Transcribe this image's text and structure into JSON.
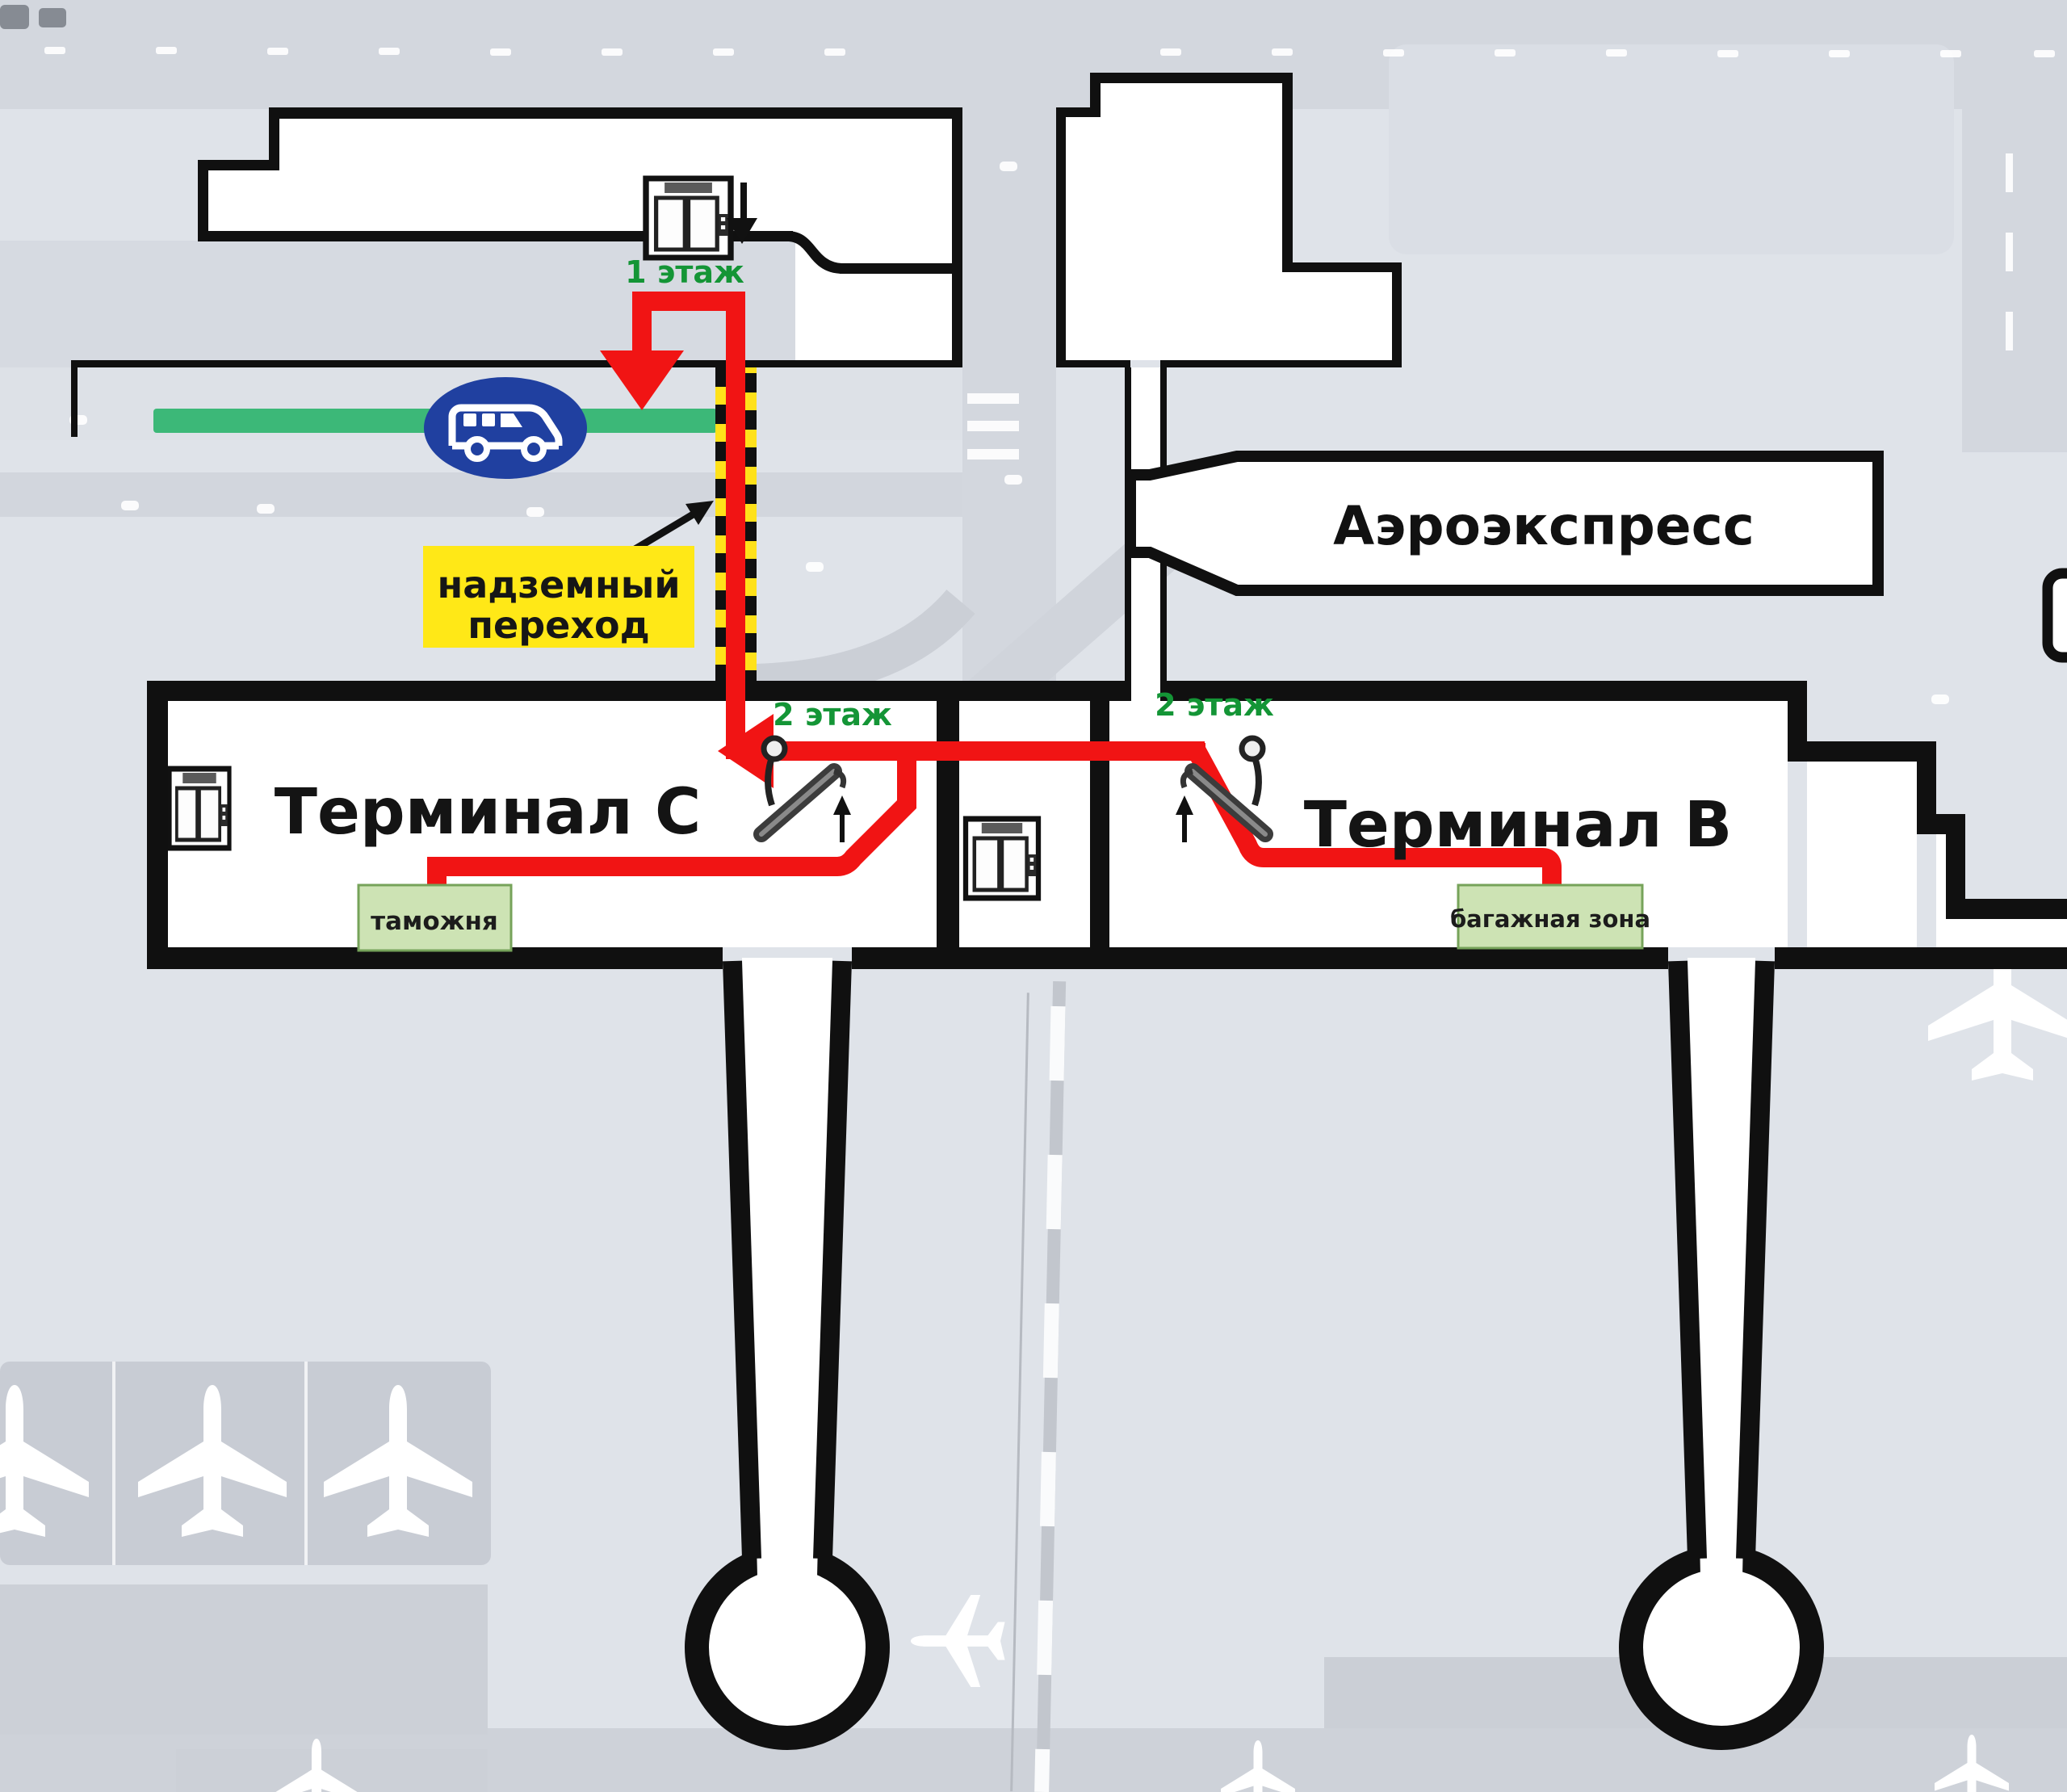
{
  "map": {
    "title_labels": {
      "terminal_c": "Терминал C",
      "terminal_b": "Терминал B",
      "aeroexpress": "Аэроэкспресс"
    },
    "floor_labels": {
      "floor_1": "1 этаж",
      "floor_2_terminal_c": "2 этаж",
      "floor_2_terminal_b": "2 этаж"
    },
    "zone_labels": {
      "overpass_line1": "надземный",
      "overpass_line2": "переход",
      "customs": "таможня",
      "baggage_zone": "багажная зона"
    },
    "colors": {
      "route_red": "#f11414",
      "crossing_yellow": "#ffe11a",
      "overpass_label_bg": "#ffe817",
      "bus_icon_blue": "#2040a0",
      "bus_lane_green": "#3cb878",
      "floor_text_green": "#149536",
      "zone_label_bg": "#cde3b4",
      "zone_label_border": "#76a35a",
      "building_outline": "#101010"
    },
    "icons": [
      "bus-icon",
      "elevator-icon",
      "escalator-icon",
      "airplane-icon",
      "down-arrow-icon",
      "overpass-pointer-arrow-icon",
      "route-arrow-icon"
    ]
  }
}
